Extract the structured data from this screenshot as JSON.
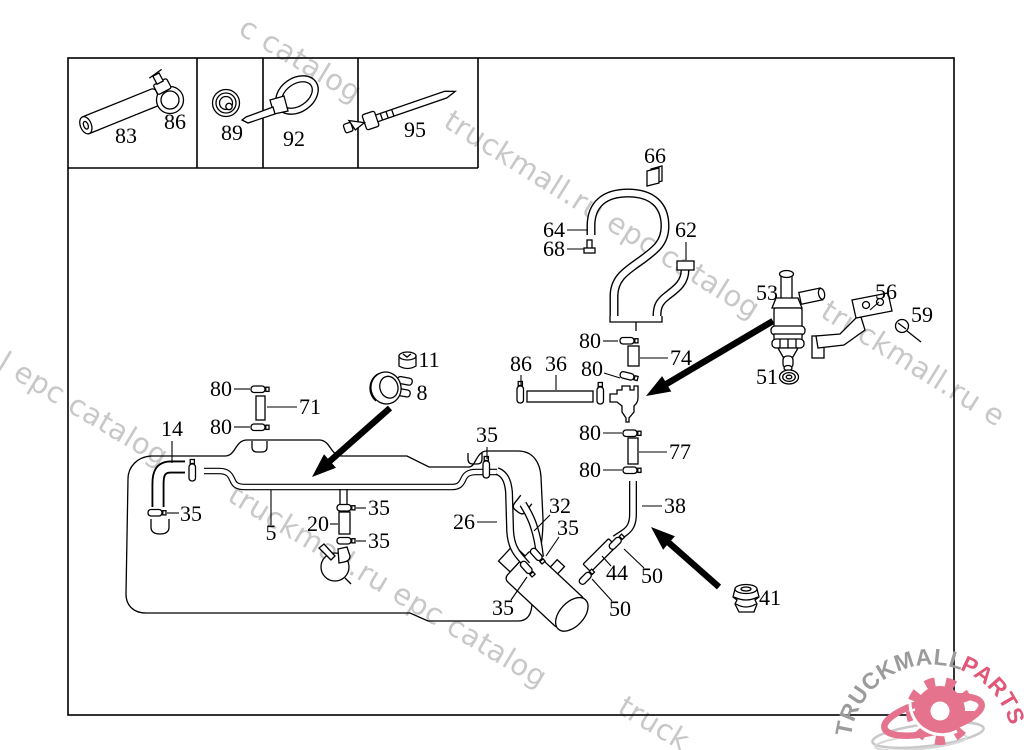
{
  "watermarks": {
    "color": "#c8c8c8",
    "items": [
      {
        "text": "c catalog",
        "x": 237,
        "y": 33,
        "angle": 31
      },
      {
        "text": "truckmall.ru epc catalog",
        "x": 442,
        "y": 126,
        "angle": 32
      },
      {
        "text": "truckmall.ru e",
        "x": 819,
        "y": 316,
        "angle": 32
      },
      {
        "text": "l epc catalog",
        "x": -4,
        "y": 368,
        "angle": 31
      },
      {
        "text": "truckmall.ru epc catalog",
        "x": 226,
        "y": 500,
        "angle": 31
      },
      {
        "text": "truck",
        "x": 616,
        "y": 712,
        "angle": 31
      }
    ]
  },
  "legend": {
    "cells": [
      {
        "part_labels": [
          {
            "text": "83",
            "x": 126,
            "y": 143
          },
          {
            "text": "86",
            "x": 175,
            "y": 129
          }
        ]
      },
      {
        "part_labels": [
          {
            "text": "89",
            "x": 232,
            "y": 140
          }
        ]
      },
      {
        "part_labels": [
          {
            "text": "92",
            "x": 294,
            "y": 146
          }
        ]
      },
      {
        "part_labels": [
          {
            "text": "95",
            "x": 415,
            "y": 137
          }
        ]
      }
    ]
  },
  "callouts": [
    {
      "label": "66",
      "x": 655,
      "y": 163,
      "leader": null
    },
    {
      "label": "64",
      "x": 554,
      "y": 237,
      "leader": [
        567,
        230,
        588,
        230
      ]
    },
    {
      "label": "68",
      "x": 554,
      "y": 256,
      "leader": [
        567,
        249,
        584,
        249
      ]
    },
    {
      "label": "62",
      "x": 686,
      "y": 237,
      "leader": [
        686,
        242,
        686,
        260
      ]
    },
    {
      "label": "53",
      "x": 767,
      "y": 300,
      "leader": null
    },
    {
      "label": "56",
      "x": 886,
      "y": 299,
      "leader": [
        879,
        302,
        870,
        310
      ]
    },
    {
      "label": "59",
      "x": 922,
      "y": 322,
      "leader": null
    },
    {
      "label": "51",
      "x": 767,
      "y": 384,
      "leader": null
    },
    {
      "label": "80",
      "x": 590,
      "y": 348,
      "leader": [
        603,
        341,
        618,
        341
      ]
    },
    {
      "label": "74",
      "x": 681,
      "y": 365,
      "leader": [
        668,
        358,
        640,
        358
      ]
    },
    {
      "label": "80",
      "x": 592,
      "y": 376,
      "leader": [
        604,
        373,
        620,
        378
      ]
    },
    {
      "label": "86",
      "x": 521,
      "y": 371,
      "leader": [
        521,
        375,
        521,
        385
      ]
    },
    {
      "label": "36",
      "x": 556,
      "y": 371,
      "leader": [
        556,
        375,
        556,
        390
      ]
    },
    {
      "label": "80",
      "x": 590,
      "y": 440,
      "leader": [
        603,
        433,
        622,
        433
      ]
    },
    {
      "label": "77",
      "x": 680,
      "y": 459,
      "leader": [
        667,
        452,
        639,
        452
      ]
    },
    {
      "label": "80",
      "x": 590,
      "y": 477,
      "leader": [
        603,
        470,
        622,
        470
      ]
    },
    {
      "label": "38",
      "x": 675,
      "y": 513,
      "leader": [
        662,
        506,
        642,
        506
      ]
    },
    {
      "label": "11",
      "x": 429,
      "y": 367,
      "leader": null
    },
    {
      "label": "8",
      "x": 422,
      "y": 400,
      "leader": null
    },
    {
      "label": "80",
      "x": 221,
      "y": 396,
      "leader": [
        234,
        389,
        250,
        389
      ]
    },
    {
      "label": "71",
      "x": 310,
      "y": 414,
      "leader": [
        297,
        407,
        267,
        407
      ]
    },
    {
      "label": "80",
      "x": 221,
      "y": 434,
      "leader": [
        234,
        427,
        250,
        427
      ]
    },
    {
      "label": "14",
      "x": 172,
      "y": 436,
      "leader": [
        172,
        441,
        172,
        463
      ]
    },
    {
      "label": "35",
      "x": 191,
      "y": 521,
      "leader": [
        179,
        513,
        167,
        513
      ]
    },
    {
      "label": "5",
      "x": 271,
      "y": 540,
      "leader": [
        271,
        525,
        271,
        490
      ]
    },
    {
      "label": "20",
      "x": 318,
      "y": 531,
      "leader": [
        330,
        524,
        338,
        524
      ]
    },
    {
      "label": "35",
      "x": 379,
      "y": 515,
      "leader": [
        366,
        508,
        356,
        508
      ]
    },
    {
      "label": "35",
      "x": 379,
      "y": 548,
      "leader": [
        366,
        541,
        356,
        541
      ]
    },
    {
      "label": "35",
      "x": 487,
      "y": 442,
      "leader": [
        487,
        447,
        487,
        459
      ]
    },
    {
      "label": "26",
      "x": 464,
      "y": 529,
      "leader": [
        477,
        522,
        497,
        522
      ]
    },
    {
      "label": "32",
      "x": 560,
      "y": 513,
      "leader": [
        550,
        515,
        534,
        531
      ]
    },
    {
      "label": "35",
      "x": 568,
      "y": 535,
      "leader": [
        559,
        537,
        546,
        556
      ]
    },
    {
      "label": "35",
      "x": 503,
      "y": 615,
      "leader": [
        511,
        600,
        527,
        577
      ]
    },
    {
      "label": "44",
      "x": 617,
      "y": 580,
      "leader": [
        611,
        566,
        602,
        556
      ]
    },
    {
      "label": "50",
      "x": 652,
      "y": 583,
      "leader": [
        644,
        568,
        624,
        549
      ]
    },
    {
      "label": "50",
      "x": 620,
      "y": 616,
      "leader": [
        612,
        601,
        592,
        579
      ]
    },
    {
      "label": "41",
      "x": 770,
      "y": 605,
      "leader": null
    }
  ],
  "logo": {
    "text_gray": "TRUCKMALL",
    "text_pink": "PARTS",
    "gray": "#9b9b9b",
    "pink": "#e25677",
    "gear_pink": "#e5738e",
    "swoosh_gray": "#c9c9c9"
  }
}
